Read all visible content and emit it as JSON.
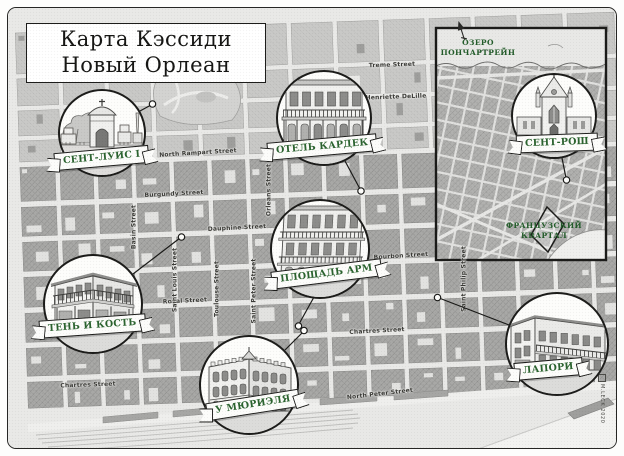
{
  "title": {
    "line1": "Карта Кэссиди",
    "line2": "Новый Орлеан"
  },
  "inset": {
    "lake_line1": "ОЗЕРО",
    "lake_line2": "ПОНЧАРТРЕЙН",
    "district_line1": "ФРАНЦУЗСКИЙ",
    "district_line2": "КВАРТАЛ"
  },
  "vignettes": [
    {
      "id": "sent-luis",
      "label": "СЕНТ-ЛУИС I",
      "subject": "cemetery-gate"
    },
    {
      "id": "otel-kardek",
      "label": "ОТЕЛЬ КАРДЕК",
      "subject": "balcony-hotel"
    },
    {
      "id": "sent-rosh",
      "label": "СЕНТ-РОШ",
      "subject": "gothic-chapel"
    },
    {
      "id": "ploshchad-arm",
      "label": "ПЛОЩАДЬ АРМ",
      "subject": "pontalba-balconies"
    },
    {
      "id": "ten-i-kost",
      "label": "ТЕНЬ И КОСТЬ",
      "subject": "corner-building"
    },
    {
      "id": "u-muriela",
      "label": "У МЮРИЭЛЯ",
      "subject": "corner-restaurant"
    },
    {
      "id": "lapori",
      "label": "ЛАПОРИ",
      "subject": "mansion"
    }
  ],
  "streets": [
    "Treme Street",
    "Henriette DeLille",
    "North Rampart Street",
    "Burgundy Street",
    "Dauphine Street",
    "Royal Street",
    "Bourbon Street",
    "Chartres Street",
    "Chartres Street",
    "North Peter Street",
    "Basin Street",
    "Orleans Street",
    "Saint Louis Street",
    "Toulouse Street",
    "Saint Peter Street",
    "Saint Philip Street"
  ],
  "signature": "M.LECK 2020",
  "colors": {
    "banner_text": "#2b632f",
    "district_text": "#235c2a",
    "quarter_block": "#a8a8a6",
    "treme_block": "#c9c9c7",
    "street": "#e9e9e7",
    "ink": "#1d1d1b"
  }
}
